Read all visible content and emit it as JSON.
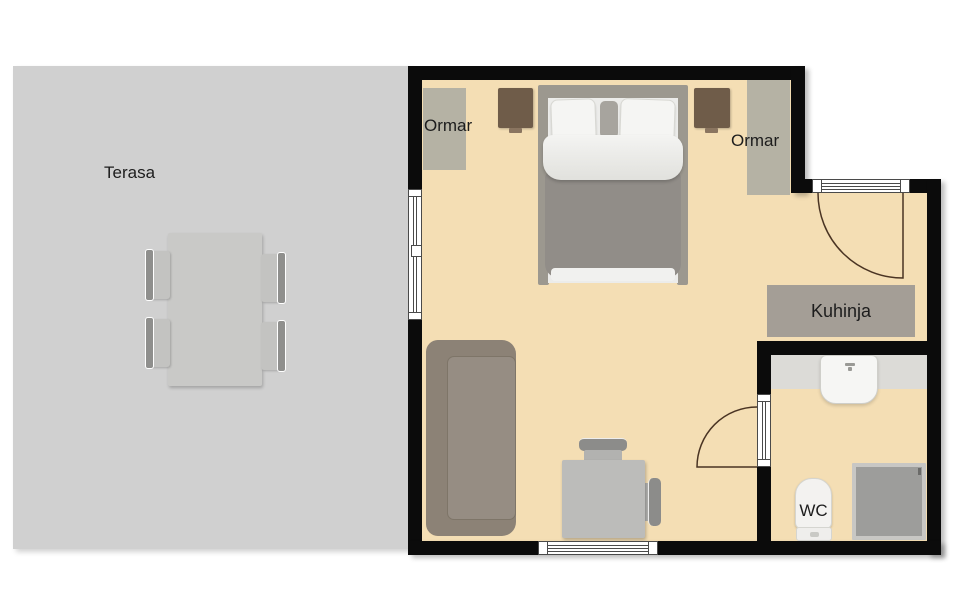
{
  "plan_title": "Apartment floor plan with terrace",
  "rooms": {
    "terrace": {
      "label": "Terasa"
    },
    "wardrobe_left": {
      "label": "Ormar"
    },
    "wardrobe_right": {
      "label": "Ormar"
    },
    "kitchen": {
      "label": "Kuhinja"
    },
    "wc": {
      "label": "WC"
    }
  },
  "colors": {
    "background": "#ffffff",
    "wall": "#0b0b0b",
    "floor": "#f4deb4",
    "terrace": "#d0d0d0",
    "wardrobe": "#b5b2a4",
    "kitchen_unit": "#a49e96",
    "bathroom_counter": "#dcdbd7",
    "shower_tray": "#9d9d9b",
    "sofa": "#8c8276",
    "bed_blanket": "#918d88",
    "nightstand": "#6f5c49",
    "door_swing": "#4a3423",
    "label_text": "#1d1d1d"
  }
}
